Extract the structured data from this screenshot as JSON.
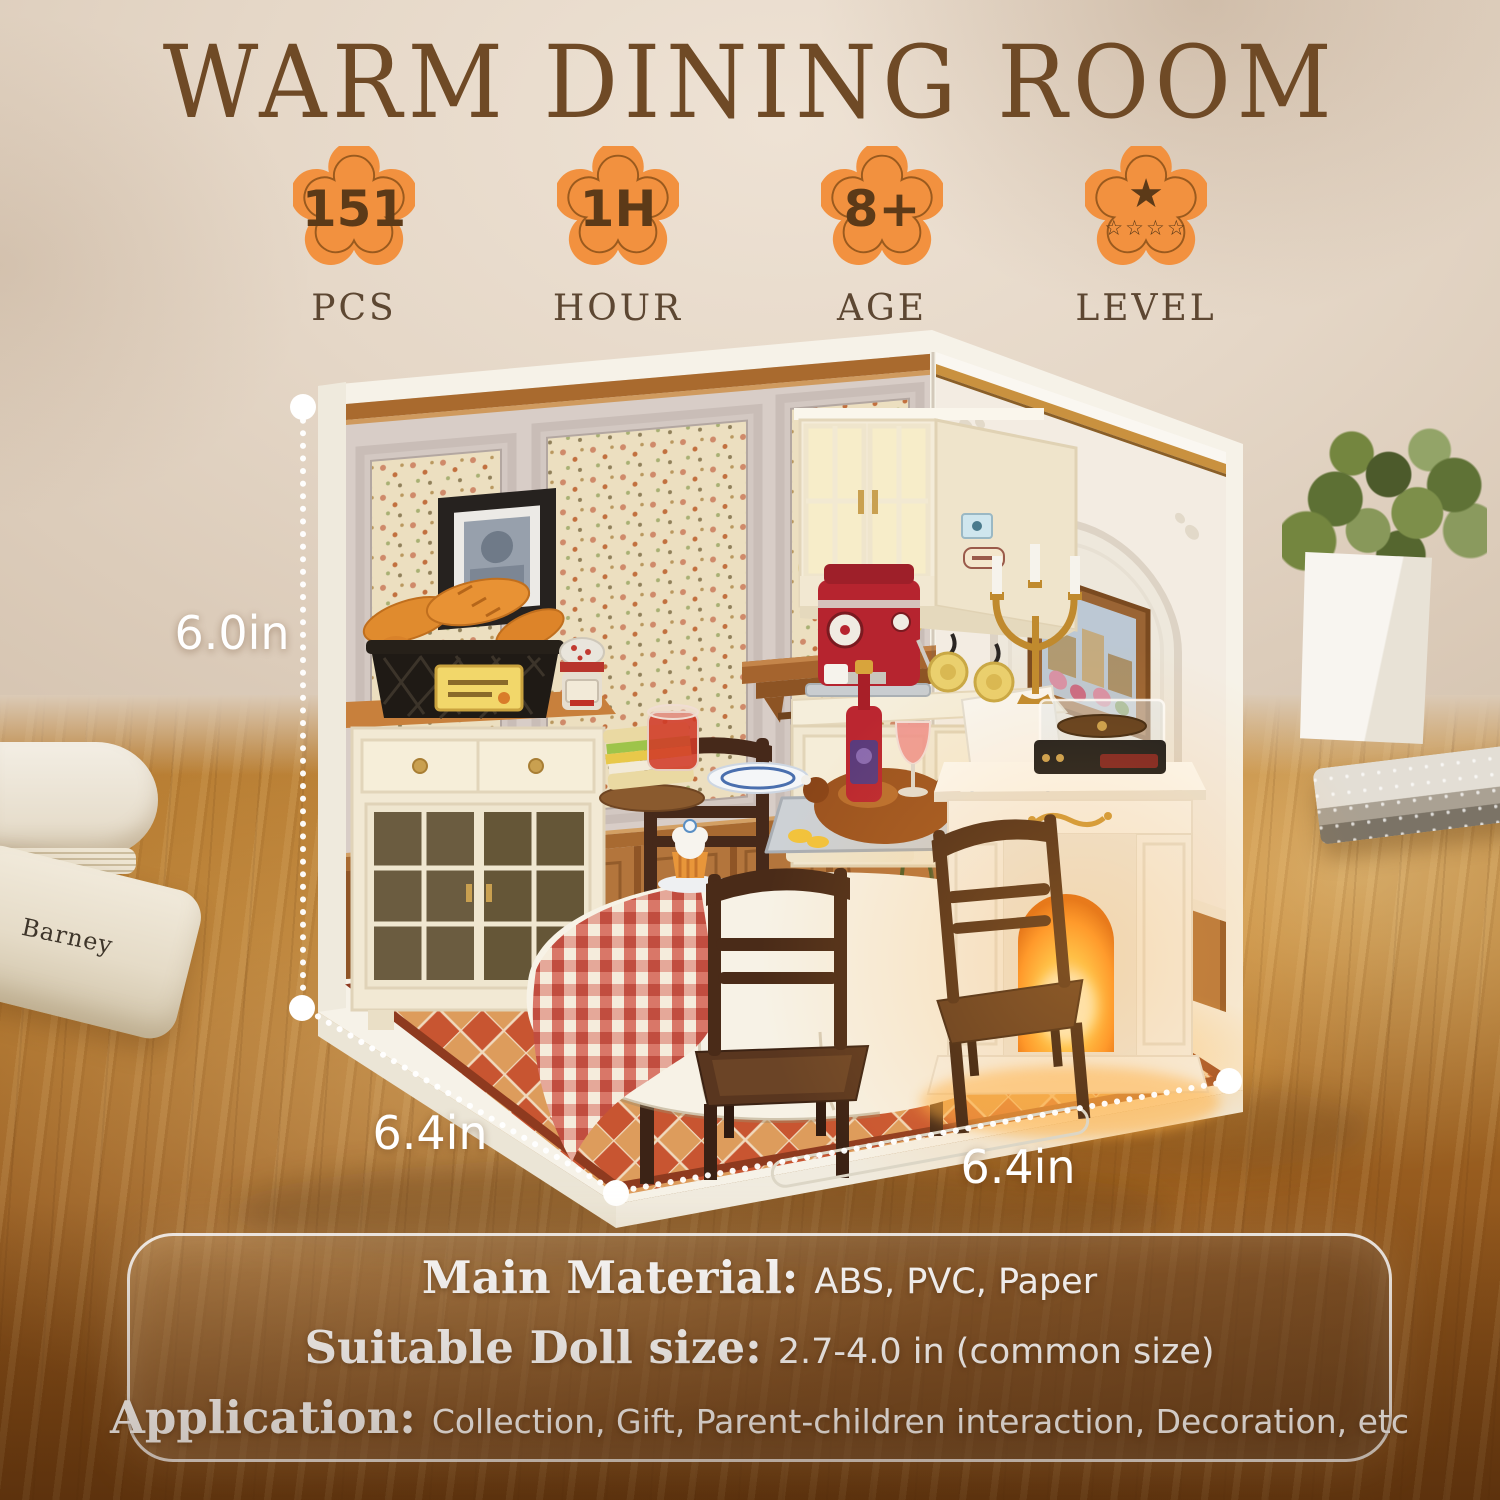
{
  "title": "WARM DINING ROOM",
  "badges": [
    {
      "value": "151",
      "label": "PCS"
    },
    {
      "value": "1H",
      "label": "HOUR"
    },
    {
      "value": "8+",
      "label": "AGE"
    },
    {
      "label": "LEVEL",
      "star_big": "★",
      "stars_small": "☆☆☆☆"
    }
  ],
  "dimensions": {
    "height": "6.0in",
    "depth": "6.4in",
    "width": "6.4in"
  },
  "specs": {
    "material_label": "Main Material:",
    "material_value": "ABS, PVC, Paper",
    "doll_label": "Suitable Doll size:",
    "doll_value": "2.7-4.0 in (common size)",
    "application_label": "Application:",
    "application_value": "Collection, Gift, Parent-children interaction, Decoration, etc"
  },
  "props": {
    "book_spine_text": "Barney"
  },
  "colors": {
    "badge_orange": "#F2913F",
    "badge_text_brown": "#5C3A18",
    "title_brown": "#6F4A26",
    "badge_label_brown": "#5D4732",
    "dimension_text": "#FFFFFF",
    "panel_border": "#FFFFFF"
  }
}
